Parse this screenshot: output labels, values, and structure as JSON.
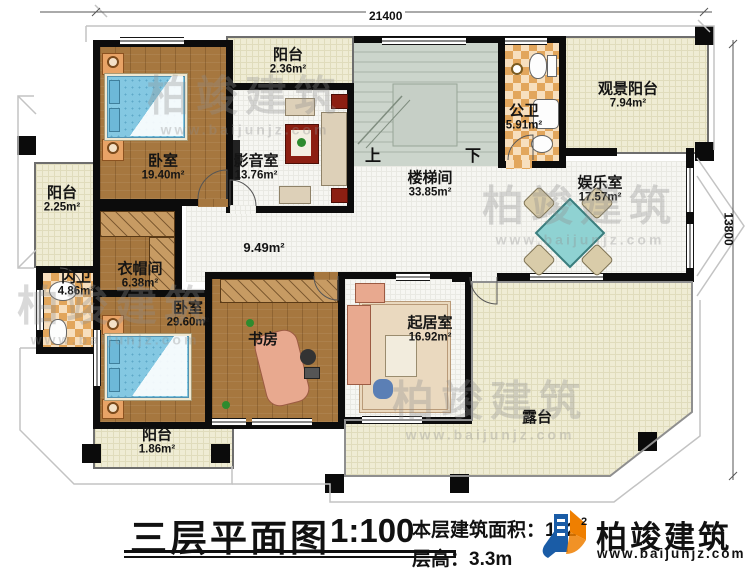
{
  "plan": {
    "title": "三层平面图",
    "scale": "1:100",
    "floor_area_label": "本层建筑面积：",
    "floor_area_value": "182",
    "floor_area_sup": "2",
    "floor_height_label": "层高：",
    "floor_height_value": "3.3m",
    "dim_top": "21400",
    "dim_right": "13800",
    "up_label": "上",
    "down_label": "下"
  },
  "brand": {
    "name": "柏竣建筑",
    "site": "www.baijunjz.com"
  },
  "watermark": {
    "name": "柏竣建筑",
    "site": "www.baijunjz.com"
  },
  "rooms": [
    {
      "name": "卧室",
      "area": "19.40m²"
    },
    {
      "name": "阳台",
      "area": "2.36m²"
    },
    {
      "name": "影音室",
      "area": "13.76m²"
    },
    {
      "name": "楼梯间",
      "area": "33.85m²"
    },
    {
      "name": "公卫",
      "area": "5.91m²"
    },
    {
      "name": "观景阳台",
      "area": "7.94m²"
    },
    {
      "name": "娱乐室",
      "area": "17.57m²"
    },
    {
      "name": "阳台",
      "area": "2.25m²"
    },
    {
      "name": "内卫",
      "area": "4.86m²"
    },
    {
      "name": "衣帽间",
      "area": "6.38m²"
    },
    {
      "name": "卧室",
      "area": "29.60m²"
    },
    {
      "name": "书房",
      "area": ""
    },
    {
      "name": "起居室",
      "area": "16.92m²"
    },
    {
      "name": "露台",
      "area": ""
    },
    {
      "name": "阳台",
      "area": "1.86m²"
    },
    {
      "name": "",
      "area": "9.49m²"
    }
  ]
}
